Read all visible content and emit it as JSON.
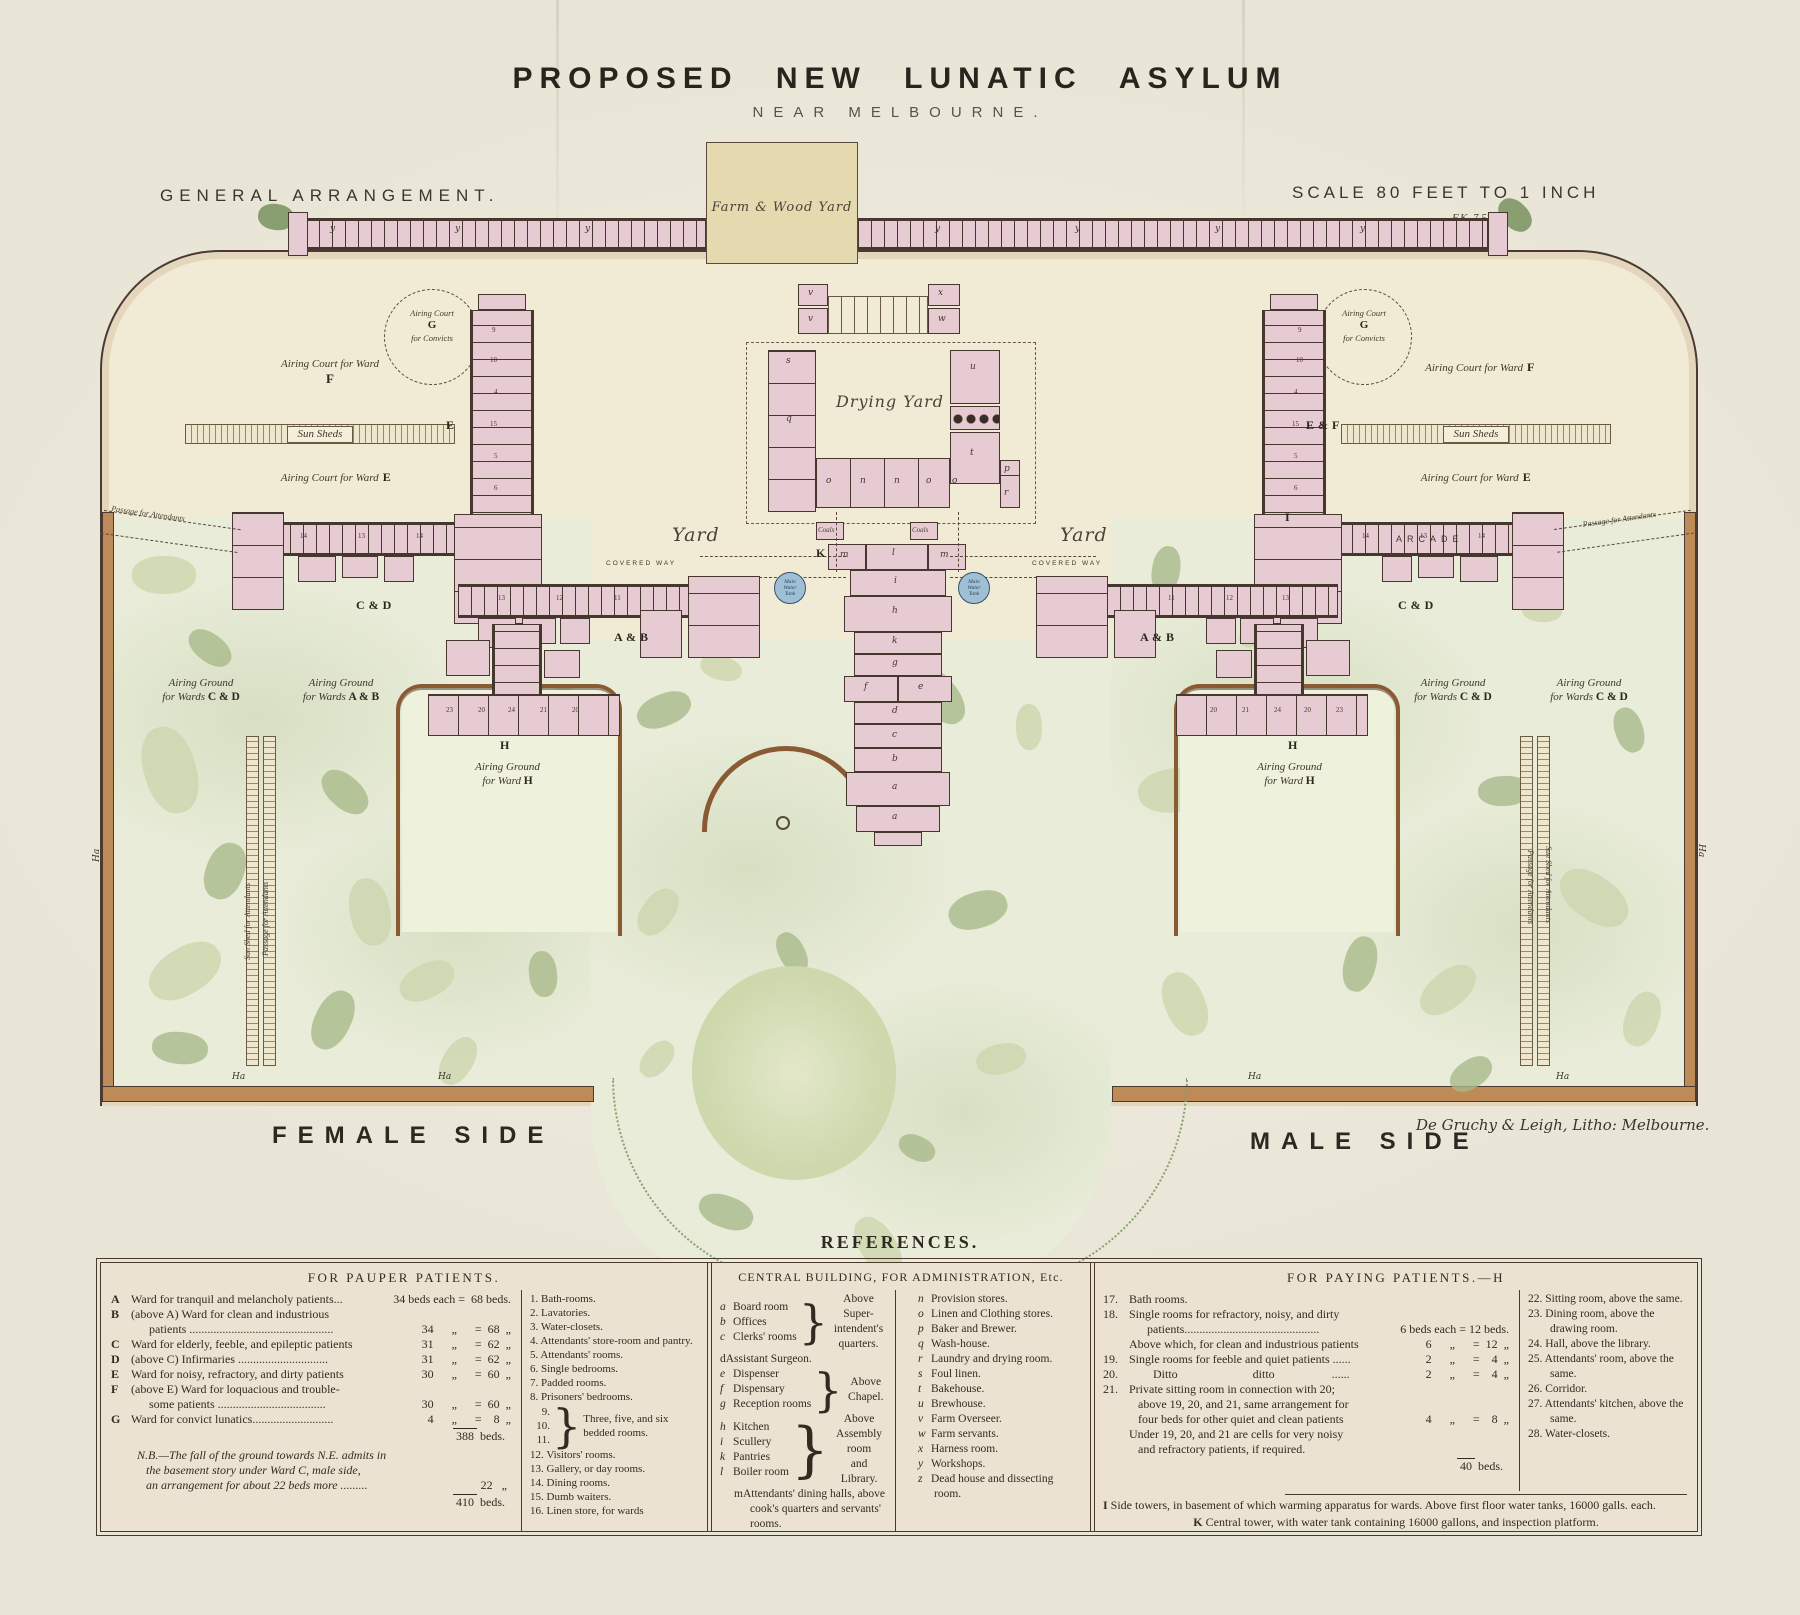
{
  "title": {
    "main": "PROPOSED NEW LUNATIC ASYLUM",
    "sub": "NEAR MELBOURNE."
  },
  "corner": {
    "left": "GENERAL ARRANGEMENT.",
    "scale": "SCALE 80 FEET TO 1 INCH",
    "scale_note": "F.K. 7 57"
  },
  "plan": {
    "farm_wood_yard": "Farm & Wood Yard",
    "drying_yard": "Drying Yard",
    "yard_left": "Yard",
    "yard_right": "Yard",
    "tank_label": "Main\nWater\nTank",
    "sun_sheds": "Sun Sheds",
    "court_f": {
      "text": "Airing Court for Ward",
      "marker": "F"
    },
    "court_e": {
      "text": "Airing Court for Ward",
      "marker": "E"
    },
    "convict": {
      "l1": "Airing Court",
      "marker": "G",
      "l2": "for Convicts"
    },
    "arcade": "ARCADE",
    "covered_way": "COVERED WAY",
    "passage": "Passage for Attendants",
    "grounds": [
      {
        "x": 136,
        "y": 676,
        "w": 130,
        "l1": "Airing Ground",
        "pre": "for Wards ",
        "m": "C & D"
      },
      {
        "x": 276,
        "y": 676,
        "w": 130,
        "l1": "Airing Ground",
        "pre": "for Wards ",
        "m": "A & B"
      },
      {
        "x": 430,
        "y": 760,
        "w": 155,
        "l1": "Airing Ground",
        "pre": "for Ward ",
        "m": "H"
      },
      {
        "x": 1388,
        "y": 676,
        "w": 130,
        "l1": "Airing Ground",
        "pre": "for Wards ",
        "m": "C & D"
      },
      {
        "x": 1524,
        "y": 676,
        "w": 130,
        "l1": "Airing Ground",
        "pre": "for Wards ",
        "m": "C & D"
      },
      {
        "x": 1212,
        "y": 760,
        "w": 155,
        "l1": "Airing Ground",
        "pre": "for Ward ",
        "m": "H"
      }
    ],
    "markers": [
      {
        "t": "E",
        "x": 446,
        "y": 418
      },
      {
        "t": "E & F",
        "x": 1306,
        "y": 418
      },
      {
        "t": "C & D",
        "x": 356,
        "y": 598
      },
      {
        "t": "C & D",
        "x": 1398,
        "y": 598
      },
      {
        "t": "A & B",
        "x": 614,
        "y": 630
      },
      {
        "t": "A & B",
        "x": 1140,
        "y": 630
      },
      {
        "t": "H",
        "x": 500,
        "y": 738
      },
      {
        "t": "H",
        "x": 1288,
        "y": 738
      },
      {
        "t": "I",
        "x": 1285,
        "y": 510
      },
      {
        "t": "K",
        "x": 816,
        "y": 546
      }
    ],
    "room_letters": [
      {
        "t": "s",
        "x": 786,
        "y": 356
      },
      {
        "t": "q",
        "x": 786,
        "y": 414
      },
      {
        "t": "u",
        "x": 970,
        "y": 362
      },
      {
        "t": "t",
        "x": 970,
        "y": 448
      },
      {
        "t": "o",
        "x": 826,
        "y": 476
      },
      {
        "t": "n",
        "x": 860,
        "y": 476
      },
      {
        "t": "n",
        "x": 894,
        "y": 476
      },
      {
        "t": "o",
        "x": 926,
        "y": 476
      },
      {
        "t": "o",
        "x": 952,
        "y": 476
      },
      {
        "t": "p",
        "x": 1004,
        "y": 464
      },
      {
        "t": "r",
        "x": 1004,
        "y": 488
      },
      {
        "t": "m",
        "x": 840,
        "y": 550
      },
      {
        "t": "l",
        "x": 892,
        "y": 548
      },
      {
        "t": "m",
        "x": 940,
        "y": 550
      },
      {
        "t": "i",
        "x": 894,
        "y": 576
      },
      {
        "t": "h",
        "x": 892,
        "y": 606
      },
      {
        "t": "k",
        "x": 892,
        "y": 636
      },
      {
        "t": "g",
        "x": 892,
        "y": 658
      },
      {
        "t": "f",
        "x": 864,
        "y": 682
      },
      {
        "t": "e",
        "x": 918,
        "y": 682
      },
      {
        "t": "d",
        "x": 892,
        "y": 706
      },
      {
        "t": "c",
        "x": 892,
        "y": 730
      },
      {
        "t": "b",
        "x": 892,
        "y": 754
      },
      {
        "t": "a",
        "x": 892,
        "y": 782
      },
      {
        "t": "a",
        "x": 892,
        "y": 812
      },
      {
        "t": "y",
        "x": 330,
        "y": 224
      },
      {
        "t": "y",
        "x": 455,
        "y": 224
      },
      {
        "t": "y",
        "x": 585,
        "y": 224
      },
      {
        "t": "y",
        "x": 935,
        "y": 224
      },
      {
        "t": "y",
        "x": 1075,
        "y": 224
      },
      {
        "t": "y",
        "x": 1215,
        "y": 224
      },
      {
        "t": "y",
        "x": 1360,
        "y": 224
      },
      {
        "t": "v",
        "x": 808,
        "y": 288
      },
      {
        "t": "v",
        "x": 808,
        "y": 314
      },
      {
        "t": "x",
        "x": 938,
        "y": 288
      },
      {
        "t": "w",
        "x": 938,
        "y": 314
      }
    ],
    "coals": [
      {
        "t": "Coals",
        "x": 818,
        "y": 526
      },
      {
        "t": "Coals",
        "x": 912,
        "y": 526
      }
    ],
    "room_numbers": [
      {
        "t": "14",
        "x": 300,
        "y": 532
      },
      {
        "t": "13",
        "x": 358,
        "y": 532
      },
      {
        "t": "14",
        "x": 416,
        "y": 532
      },
      {
        "t": "13",
        "x": 498,
        "y": 594
      },
      {
        "t": "12",
        "x": 556,
        "y": 594
      },
      {
        "t": "11",
        "x": 614,
        "y": 594
      },
      {
        "t": "14",
        "x": 1478,
        "y": 532
      },
      {
        "t": "13",
        "x": 1420,
        "y": 532
      },
      {
        "t": "14",
        "x": 1362,
        "y": 532
      },
      {
        "t": "13",
        "x": 1282,
        "y": 594
      },
      {
        "t": "12",
        "x": 1226,
        "y": 594
      },
      {
        "t": "11",
        "x": 1168,
        "y": 594
      },
      {
        "t": "23",
        "x": 446,
        "y": 706
      },
      {
        "t": "20",
        "x": 478,
        "y": 706
      },
      {
        "t": "24",
        "x": 508,
        "y": 706
      },
      {
        "t": "21",
        "x": 540,
        "y": 706
      },
      {
        "t": "20",
        "x": 572,
        "y": 706
      },
      {
        "t": "23",
        "x": 1336,
        "y": 706
      },
      {
        "t": "20",
        "x": 1304,
        "y": 706
      },
      {
        "t": "24",
        "x": 1274,
        "y": 706
      },
      {
        "t": "21",
        "x": 1242,
        "y": 706
      },
      {
        "t": "20",
        "x": 1210,
        "y": 706
      },
      {
        "t": "9",
        "x": 492,
        "y": 326
      },
      {
        "t": "10",
        "x": 490,
        "y": 356
      },
      {
        "t": "4",
        "x": 494,
        "y": 388
      },
      {
        "t": "15",
        "x": 490,
        "y": 420
      },
      {
        "t": "5",
        "x": 494,
        "y": 452
      },
      {
        "t": "6",
        "x": 494,
        "y": 484
      },
      {
        "t": "9",
        "x": 1298,
        "y": 326
      },
      {
        "t": "10",
        "x": 1296,
        "y": 356
      },
      {
        "t": "4",
        "x": 1294,
        "y": 388
      },
      {
        "t": "15",
        "x": 1292,
        "y": 420
      },
      {
        "t": "5",
        "x": 1294,
        "y": 452
      },
      {
        "t": "6",
        "x": 1294,
        "y": 484
      }
    ],
    "strip_labels": [
      {
        "t": "Sun Shed for Attendants",
        "x": 243,
        "y": 960,
        "rot": -90
      },
      {
        "t": "Passage for Attendants",
        "x": 261,
        "y": 956,
        "rot": -90
      },
      {
        "t": "Sun Shed for Attendants",
        "x": 1553,
        "y": 846,
        "rot": 90
      },
      {
        "t": "Passage for Attendants",
        "x": 1535,
        "y": 850,
        "rot": 90
      }
    ],
    "ha": [
      {
        "t": "Ha",
        "x": 232,
        "y": 1072
      },
      {
        "t": "Ha",
        "x": 438,
        "y": 1072
      },
      {
        "t": "Ha",
        "x": 1248,
        "y": 1072
      },
      {
        "t": "Ha",
        "x": 1556,
        "y": 1072
      },
      {
        "t": "Ha",
        "x": 92,
        "y": 862,
        "rot": -90
      },
      {
        "t": "Ha",
        "x": 1706,
        "y": 844,
        "rot": 90
      }
    ]
  },
  "footer": {
    "female": "FEMALE SIDE",
    "male": "MALE SIDE",
    "credit": "De Gruchy & Leigh, Litho: Melbourne."
  },
  "references": {
    "heading": "REFERENCES.",
    "pauper": {
      "header": "FOR PAUPER PATIENTS.",
      "rows": [
        {
          "k": "A",
          "l1": "Ward for tranquil and melancholy patients...",
          "l2": "",
          "n": "34 beds each =  68 beds."
        },
        {
          "k": "B",
          "l1": "(above A) Ward for clean and industrious",
          "l2": "      patients ................................................",
          "n": "34      „      =  68  „"
        },
        {
          "k": "C",
          "l1": "Ward for elderly, feeble, and epileptic patients",
          "l2": "",
          "n": "31      „      =  62  „"
        },
        {
          "k": "D",
          "l1": "(above C) Infirmaries ..............................",
          "l2": "",
          "n": "31      „      =  62  „"
        },
        {
          "k": "E",
          "l1": "Ward for noisy, refractory, and dirty patients",
          "l2": "",
          "n": "30      „      =  60  „"
        },
        {
          "k": "F",
          "l1": "(above E) Ward for loquacious and trouble-",
          "l2": "      some patients ....................................",
          "n": "30      „      =  60  „"
        },
        {
          "k": "G",
          "l1": "Ward for convict lunatics...........................",
          "l2": "",
          "n": "  4      „      =    8  „"
        }
      ],
      "total_num": "388",
      "total_unit": " beds.",
      "nb_l1": "N.B.—The fall of the ground towards N.E. admits in",
      "nb_l2": "   the basement story under Ward C, male side,",
      "nb_l3": "   an arrangement for about 22 beds more .........",
      "nb_num": "22   „",
      "grand_num": "410",
      "grand_unit": " beds."
    },
    "rooms1": {
      "items": [
        {
          "n": "1.",
          "t": "Bath-rooms."
        },
        {
          "n": "2.",
          "t": "Lavatories."
        },
        {
          "n": "3.",
          "t": "Water-closets."
        },
        {
          "n": "4.",
          "t": "Attendants' store-room and pantry."
        },
        {
          "n": "5.",
          "t": "Attendants' rooms."
        },
        {
          "n": "6.",
          "t": "Single bedrooms."
        },
        {
          "n": "7.",
          "t": "Padded rooms."
        },
        {
          "n": "8.",
          "t": "Prisoners' bedrooms."
        }
      ],
      "group": {
        "n1": "9.",
        "n2": "10.",
        "n3": "11.",
        "brace": "}",
        "t": "Three, five, and six bedded rooms."
      },
      "items2": [
        {
          "n": "12.",
          "t": "Visitors' rooms."
        },
        {
          "n": "13.",
          "t": "Gallery, or day rooms."
        },
        {
          "n": "14.",
          "t": "Dining rooms."
        },
        {
          "n": "15.",
          "t": "Dumb waiters."
        },
        {
          "n": "16.",
          "t": "Linen store, for wards"
        }
      ]
    },
    "central": {
      "header": "CENTRAL BUILDING, FOR ADMINISTRATION, Etc.",
      "group1": {
        "items": [
          {
            "k": "a",
            "t": "Board room"
          },
          {
            "k": "b",
            "t": "Offices"
          },
          {
            "k": "c",
            "t": "Clerks' rooms"
          }
        ],
        "note": "Above Super-\nintendent's\nquarters."
      },
      "d_key": "d",
      "d_text": "Assistant Surgeon.",
      "group2": {
        "items": [
          {
            "k": "e",
            "t": "Dispenser"
          },
          {
            "k": "f",
            "t": "Dispensary"
          },
          {
            "k": "g",
            "t": "Reception rooms"
          }
        ],
        "note": "Above\nChapel."
      },
      "group3": {
        "items": [
          {
            "k": "h",
            "t": "Kitchen"
          },
          {
            "k": "i",
            "t": "Scullery"
          },
          {
            "k": "k",
            "t": "Pantries"
          },
          {
            "k": "l",
            "t": "Boiler room"
          }
        ],
        "note": "Above\nAssembly\nroom\nand Library."
      },
      "m_key": "m",
      "m_text": "Attendants' dining halls, above cook's quarters and servants' rooms.",
      "right_items": [
        {
          "k": "n",
          "t": "Provision stores."
        },
        {
          "k": "o",
          "t": "Linen and Clothing stores."
        },
        {
          "k": "p",
          "t": "Baker and Brewer."
        },
        {
          "k": "q",
          "t": "Wash-house."
        },
        {
          "k": "r",
          "t": "Laundry and drying room."
        },
        {
          "k": "s",
          "t": "Foul linen."
        },
        {
          "k": "t",
          "t": "Bakehouse."
        },
        {
          "k": "u",
          "t": "Brewhouse."
        },
        {
          "k": "v",
          "t": "Farm Overseer."
        },
        {
          "k": "w",
          "t": "Farm servants."
        },
        {
          "k": "x",
          "t": "Harness room."
        },
        {
          "k": "y",
          "t": "Workshops."
        },
        {
          "k": "z",
          "t": "Dead house and dissecting room."
        }
      ]
    },
    "paying": {
      "header": "FOR PAYING PATIENTS.—H",
      "rows": [
        {
          "num": "17.",
          "l1": "Bath rooms.",
          "l2": "",
          "l3": "",
          "n": ""
        },
        {
          "num": "18.",
          "l1": "Single rooms for refractory, noisy, and dirty",
          "l2": "      patients.............................................",
          "l3": "",
          "n": "6 beds each = 12 beds."
        },
        {
          "num": "",
          "l1": "Above which, for clean and industrious patients",
          "l2": "",
          "l3": "",
          "n": "6      „      =  12  „"
        },
        {
          "num": "19.",
          "l1": "Single rooms for feeble and quiet patients ......",
          "l2": "",
          "l3": "",
          "n": "2      „      =    4  „"
        },
        {
          "num": "20.",
          "l1": "        Ditto                         ditto                   ......",
          "l2": "",
          "l3": "",
          "n": "2      „      =    4  „"
        },
        {
          "num": "21.",
          "l1": "Private sitting room in connection with 20;",
          "l2": "   above 19, 20, and 21, same arrangement for",
          "l3": "   four beds for other quiet and clean patients",
          "n": "4      „      =    8  „"
        },
        {
          "num": "",
          "l1": "Under 19, 20, and 21 are cells for very noisy",
          "l2": "   and refractory patients, if required.",
          "l3": "",
          "n": ""
        }
      ],
      "total_num": "40",
      "total_unit": " beds.",
      "right_items": [
        {
          "n": "22.",
          "t": "Sitting room, above the same."
        },
        {
          "n": "23.",
          "t": "Dining room, above the drawing room."
        },
        {
          "n": "24.",
          "t": "Hall, above the library."
        },
        {
          "n": "25.",
          "t": "Attendants' room, above the same."
        },
        {
          "n": "26.",
          "t": "Corridor."
        },
        {
          "n": "27.",
          "t": "Attendants' kitchen, above the same."
        },
        {
          "n": "28.",
          "t": "Water-closets."
        }
      ]
    },
    "towers": {
      "i_key": "I",
      "i_text": " Side towers, in basement of which warming apparatus for wards.  Above first floor water tanks, 16000 galls. each.",
      "k_key": "K",
      "k_text": " Central tower, with water tank containing 16000 gallons, and inspection platform."
    }
  }
}
